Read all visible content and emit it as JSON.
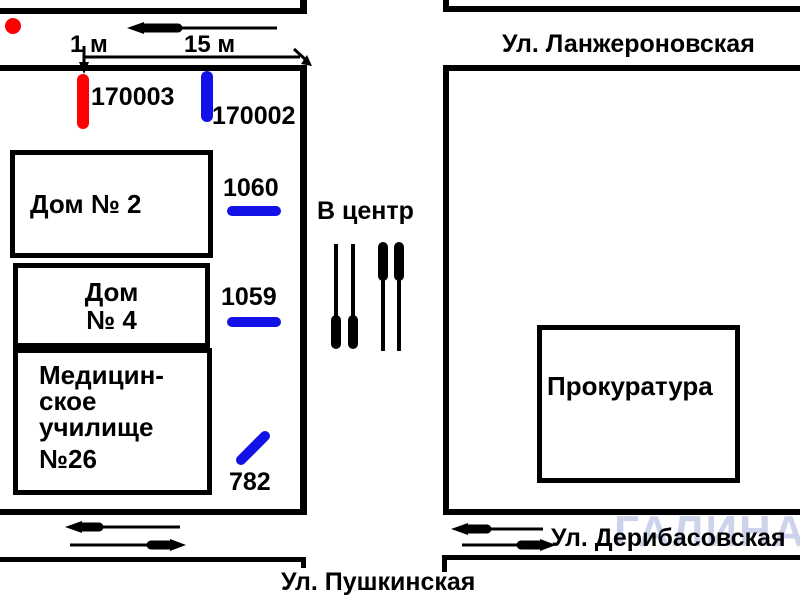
{
  "colors": {
    "red": "#ff0000",
    "blue": "#1111e8",
    "line": "#000000",
    "watermark": "#95a0d6"
  },
  "scale": {
    "one_m": "1 м",
    "fifteen_m": "15 м"
  },
  "direction": {
    "to_center": "В центр"
  },
  "streets": {
    "lanzheronovskaya": "Ул. Ланжероновская",
    "deribasovskaya": "Ул. Дерибасовская",
    "pushkinskaya": "Ул. Пушкинская"
  },
  "buildings": {
    "dom2": "Дом № 2",
    "dom4": {
      "line1": "Дом",
      "line2": "№ 4"
    },
    "med": {
      "line1": "Медицин-",
      "line2": "ское",
      "line3": "училище",
      "line4": "№26"
    },
    "prokuratura": "Прокуратура"
  },
  "poles": {
    "p170003": "170003",
    "p170002": "170002"
  },
  "stops": {
    "s1060": "1060",
    "s1059": "1059",
    "s782": "782"
  },
  "watermark": "ГАЛИНА"
}
